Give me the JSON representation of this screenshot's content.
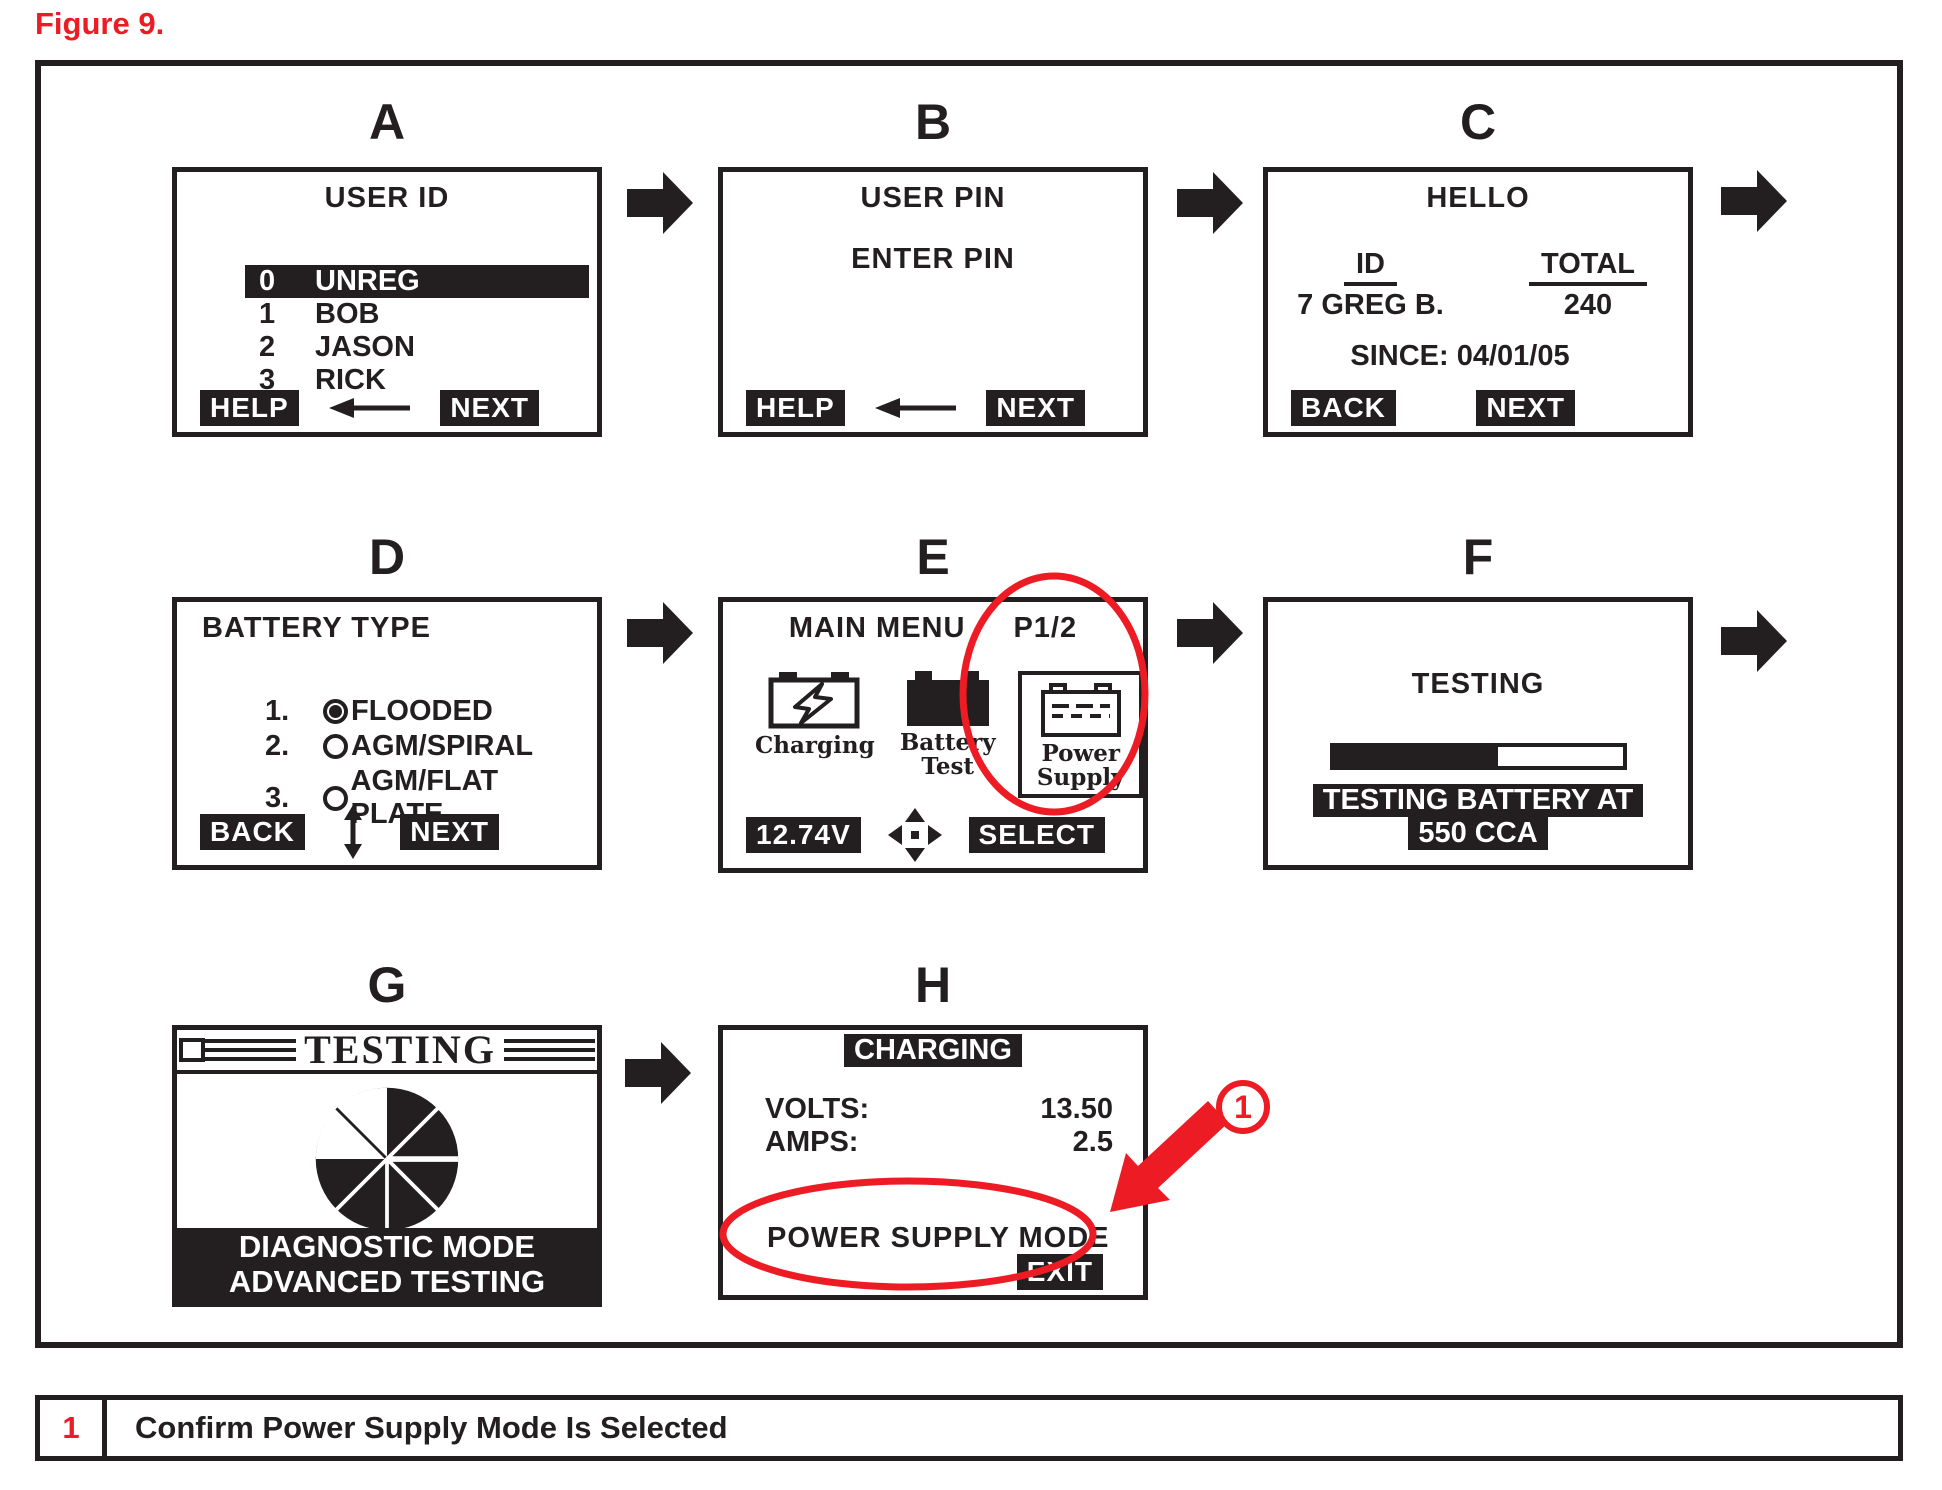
{
  "figure": {
    "label": "Figure 9."
  },
  "colors": {
    "accent_red": "#ed1c24",
    "ink_black": "#231f20"
  },
  "screens": {
    "a": {
      "label": "A",
      "title": "USER ID",
      "users": [
        {
          "num": "0",
          "name": "UNREG",
          "selected": true
        },
        {
          "num": "1",
          "name": "BOB",
          "selected": false
        },
        {
          "num": "2",
          "name": "JASON",
          "selected": false
        },
        {
          "num": "3",
          "name": "RICK",
          "selected": false
        }
      ],
      "help_label": "HELP",
      "next_label": "NEXT"
    },
    "b": {
      "label": "B",
      "title": "USER PIN",
      "prompt": "ENTER PIN",
      "help_label": "HELP",
      "next_label": "NEXT"
    },
    "c": {
      "label": "C",
      "title": "HELLO",
      "id_header": "ID",
      "id_value": "7 GREG B.",
      "total_header": "TOTAL",
      "total_value": "240",
      "since_line": "SINCE: 04/01/05",
      "back_label": "BACK",
      "next_label": "NEXT"
    },
    "d": {
      "label": "D",
      "title": "BATTERY TYPE",
      "options": [
        {
          "num": "1.",
          "name": "FLOODED",
          "selected": true
        },
        {
          "num": "2.",
          "name": "AGM/SPIRAL",
          "selected": false
        },
        {
          "num": "3.",
          "name": "AGM/FLAT PLATE",
          "selected": false
        }
      ],
      "back_label": "BACK",
      "next_label": "NEXT"
    },
    "e": {
      "label": "E",
      "title": "MAIN MENU",
      "page_indicator": "P1/2",
      "items": [
        {
          "icon": "charging-battery-icon",
          "line1": "Charging",
          "line2": ""
        },
        {
          "icon": "battery-test-icon",
          "line1": "Battery",
          "line2": "Test"
        },
        {
          "icon": "power-supply-icon",
          "line1": "Power",
          "line2": "Supply",
          "highlighted": true
        }
      ],
      "voltage_label": "12.74V",
      "select_label": "SELECT"
    },
    "f": {
      "label": "F",
      "title": "TESTING",
      "progress_pct": 57,
      "status_line1": "TESTING BATTERY AT",
      "status_line2": "550 CCA"
    },
    "g": {
      "label": "G",
      "title": "TESTING",
      "footer_line1": "DIAGNOSTIC MODE",
      "footer_line2": "ADVANCED TESTING"
    },
    "h": {
      "label": "H",
      "title": "CHARGING",
      "volts_label": "VOLTS:",
      "volts_value": "13.50",
      "amps_label": "AMPS:",
      "amps_value": "2.5",
      "mode_text": "POWER SUPPLY MODE",
      "exit_label": "EXIT"
    }
  },
  "callout": {
    "number": "1"
  },
  "caption": {
    "number": "1",
    "text": "Confirm Power Supply Mode Is Selected"
  }
}
